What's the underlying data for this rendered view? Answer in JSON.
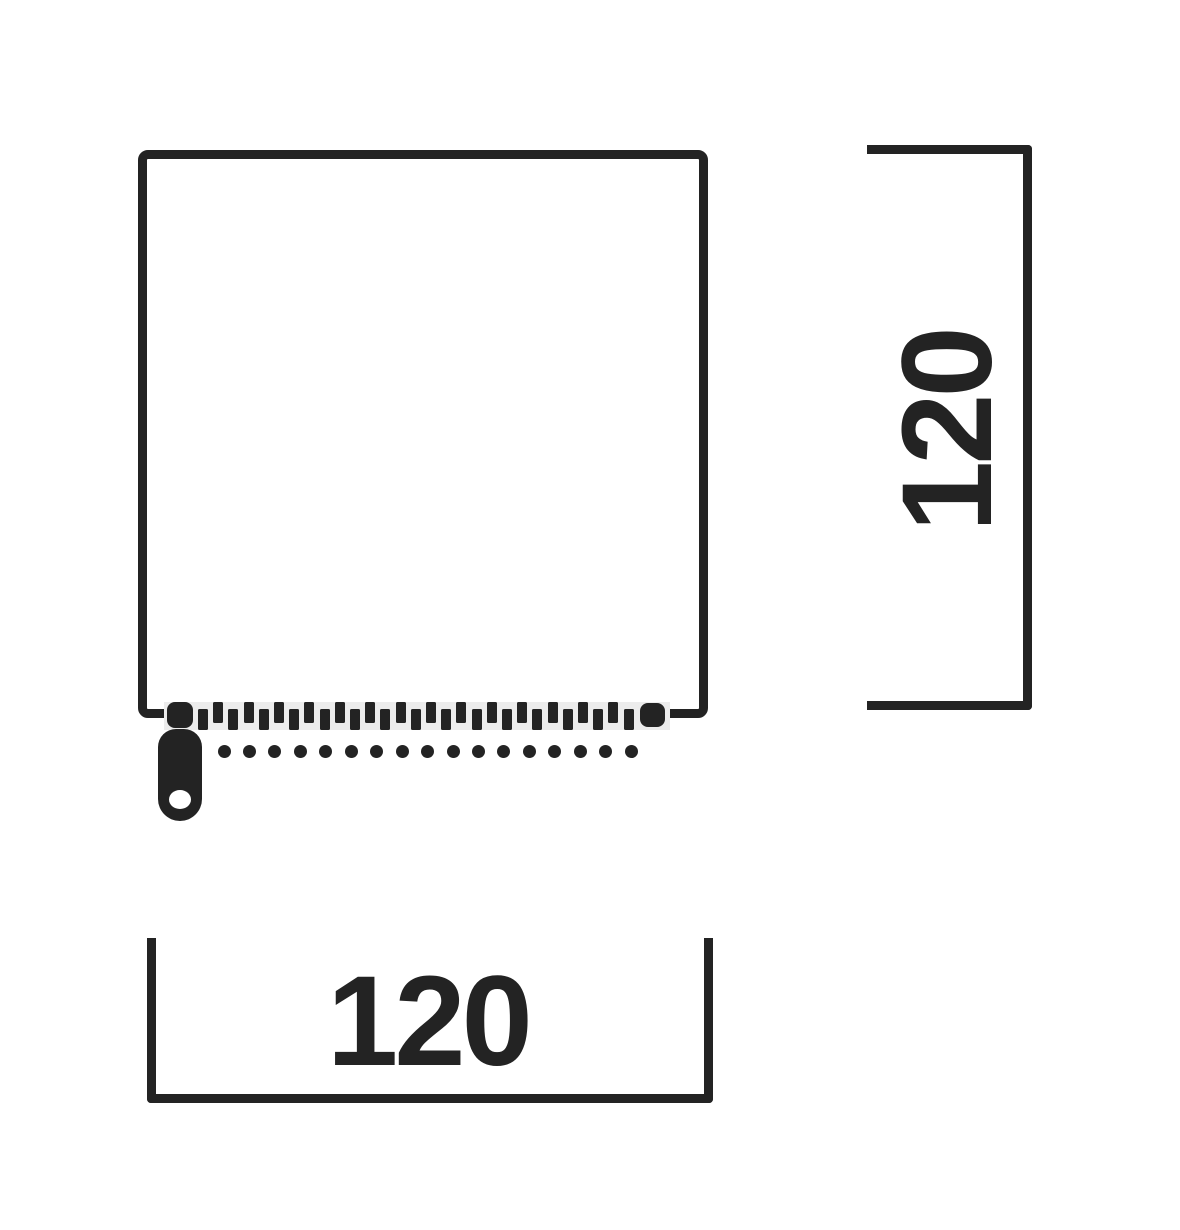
{
  "diagram": {
    "kind": "dimension-drawing",
    "subject": "square cover with zipper along bottom edge",
    "width_dimension": {
      "value": "120"
    },
    "height_dimension": {
      "value": "120"
    }
  },
  "zipper": {
    "teeth_count": 29,
    "teeth_start_x": 198,
    "teeth_period": 15.2,
    "stitch_dot_count": 17,
    "stitch_start_x": 224,
    "stitch_spacing": 25.45
  },
  "colors": {
    "ink": "#232323",
    "tape": "#ececec",
    "background": "#ffffff"
  }
}
